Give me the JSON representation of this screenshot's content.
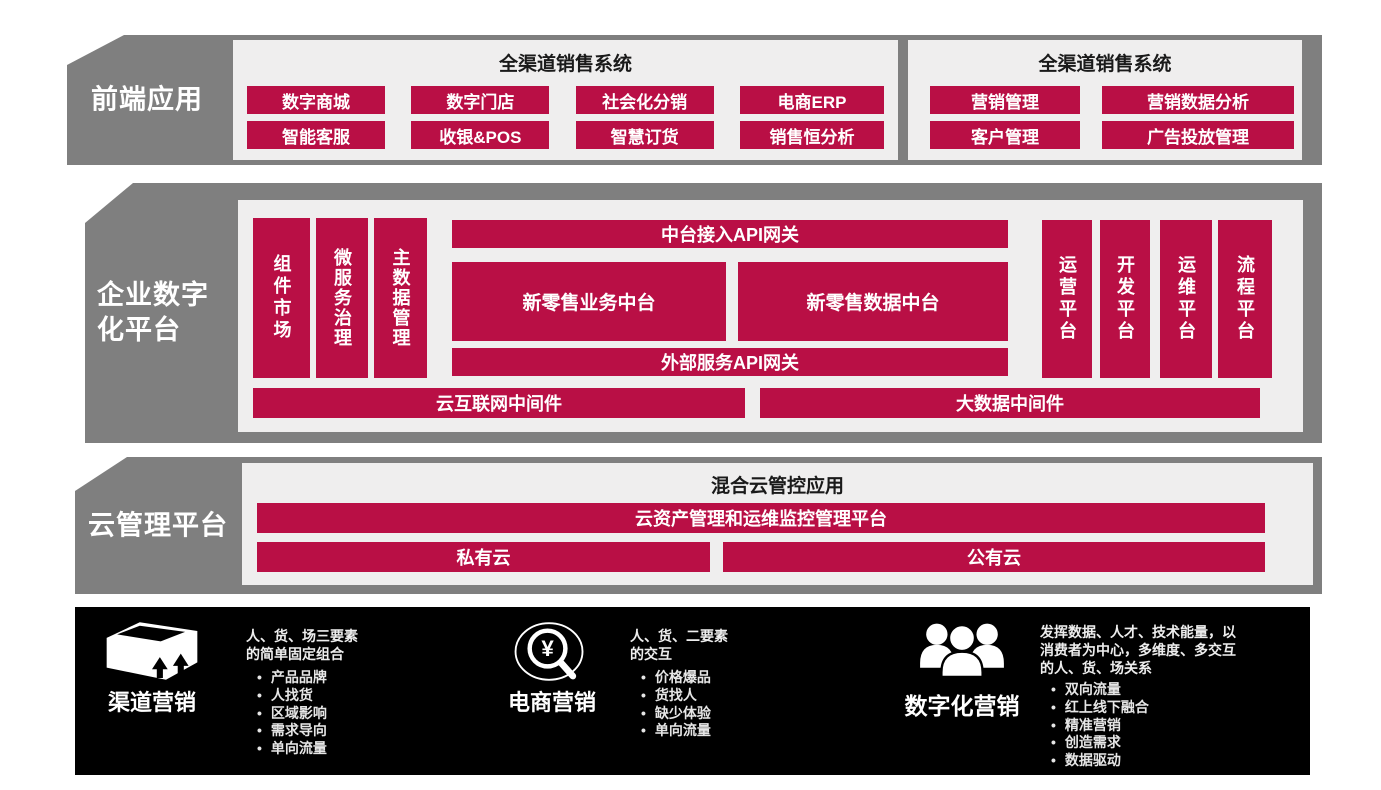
{
  "colors": {
    "band_gray": "#7f7f7f",
    "panel_bg": "#efeeee",
    "accent_red": "#b90f45",
    "marketing_bg": "#000000"
  },
  "frontend": {
    "label": "前端应用",
    "panel1": {
      "title": "全渠道销售系统",
      "row1": [
        "数字商城",
        "数字门店",
        "社会化分销",
        "电商ERP"
      ],
      "row2": [
        "智能客服",
        "收银&POS",
        "智慧订货",
        "销售恒分析"
      ]
    },
    "panel2": {
      "title": "全渠道销售系统",
      "row1": [
        "营销管理",
        "营销数据分析"
      ],
      "row2": [
        "客户管理",
        "广告投放管理"
      ]
    }
  },
  "platform": {
    "label_line1": "企业数字",
    "label_line2": "化平台",
    "left_pillars": [
      "组件市场",
      "微服务治理",
      "主数据管理"
    ],
    "gateway_top": "中台接入API网关",
    "business_center": "新零售业务中台",
    "data_center": "新零售数据中台",
    "gateway_external": "外部服务API网关",
    "right_pillars": [
      "运营平台",
      "开发平台",
      "运维平台",
      "流程平台"
    ],
    "middleware_cloud": "云互联网中间件",
    "middleware_bigdata": "大数据中间件"
  },
  "cloud": {
    "label": "云管理平台",
    "title": "混合云管控应用",
    "management_bar": "云资产管理和运维监控管理平台",
    "private_cloud": "私有云",
    "public_cloud": "公有云"
  },
  "marketing": {
    "items": [
      {
        "icon": "package-box-icon",
        "label": "渠道营销",
        "desc": "人、货、场三要素\n的简单固定组合",
        "bullets": [
          "产品品牌",
          "人找货",
          "区域影响",
          "需求导向",
          "单向流量"
        ]
      },
      {
        "icon": "magnifier-yen-icon",
        "label": "电商营销",
        "desc": "人、货、二要素\n的交互",
        "bullets": [
          "价格爆品",
          "货找人",
          "缺少体验",
          "单向流量"
        ]
      },
      {
        "icon": "people-group-icon",
        "label": "数字化营销",
        "desc": "发挥数据、人才、技术能量，以\n消费者为中心，多维度、多交互\n的人、货、场关系",
        "bullets": [
          "双向流量",
          "红上线下融合",
          "精准营销",
          "创造需求",
          "数据驱动"
        ]
      }
    ]
  }
}
